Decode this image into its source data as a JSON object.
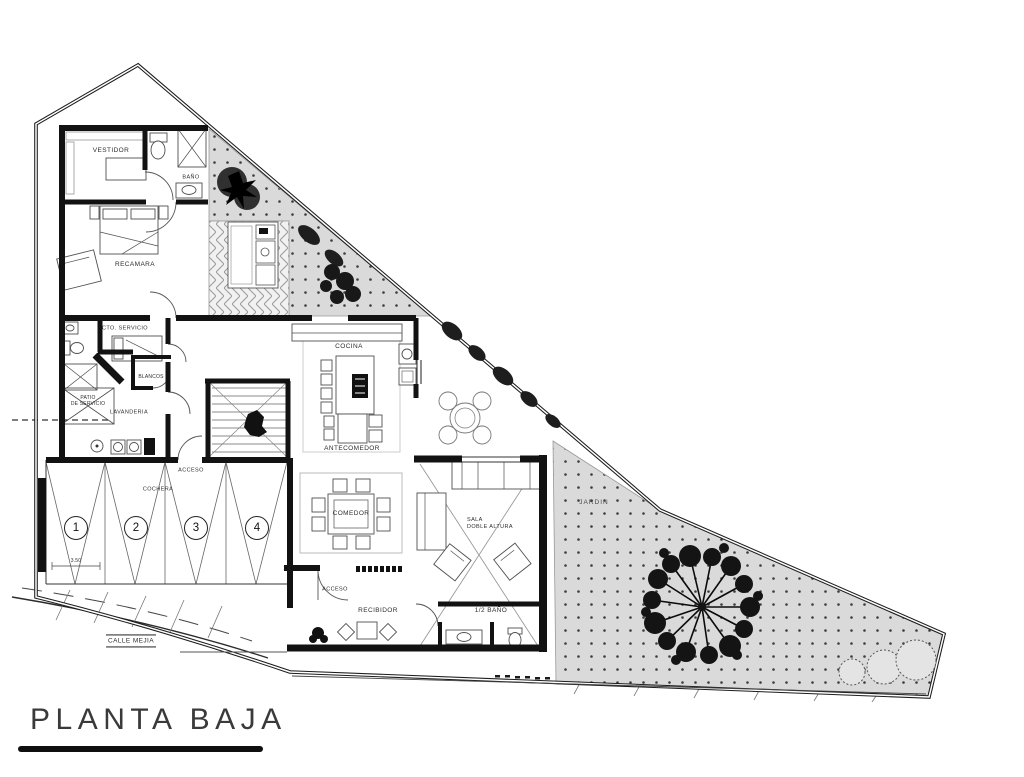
{
  "drawing": {
    "title": "PLANTA BAJA",
    "street": "CALLE MEJIA"
  },
  "rooms": {
    "vestidor": "VESTIDOR",
    "bano": "BAÑO",
    "recamara": "RECAMARA",
    "cto_servicio": "CTO. SERVICIO",
    "blancos": "BLANCOS",
    "patio_servicio_1": "PATIO",
    "patio_servicio_2": "DE SERVICIO",
    "lavanderia": "LAVANDERIA",
    "cocina": "COCINA",
    "antecomedor": "ANTECOMEDOR",
    "comedor": "COMEDOR",
    "sala_1": "SALA",
    "sala_2": "DOBLE ALTURA",
    "cochera": "COCHERA",
    "acceso_cochera": "ACCESO",
    "acceso_entrada": "ACCESO",
    "recibidor": "RECIBIDOR",
    "medio_bano": "1/2 BAÑO",
    "jardin": "JARDIN"
  },
  "parking": {
    "spot_1": "1",
    "spot_2": "2",
    "spot_3": "3",
    "spot_4": "4"
  },
  "dimensions": {
    "cochera_width": "3.50"
  },
  "colors": {
    "walls": "#121212",
    "paper": "#ffffff",
    "garden_fill": "#dadada",
    "ink": "#2e2e2e"
  }
}
